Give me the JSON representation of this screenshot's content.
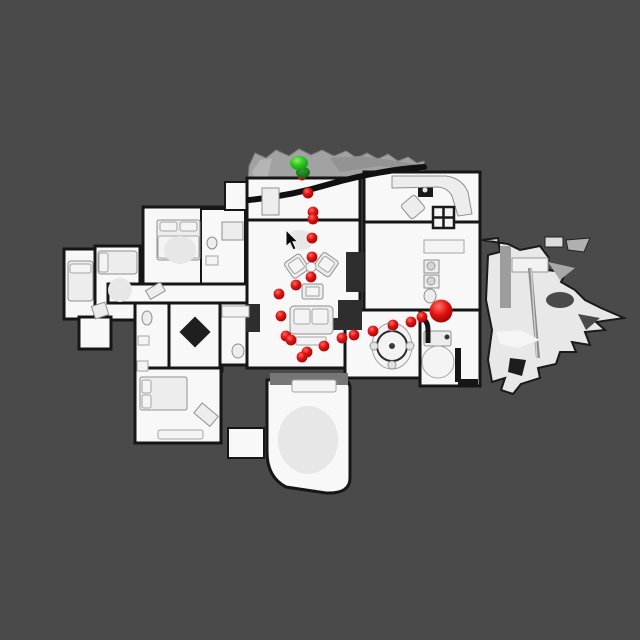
{
  "scene": {
    "description": "Top-down orthographic view of a 3D-scanned house interior with a navigation trajectory overlay",
    "background_color": "#4a4a4a",
    "floor_color": "#f8f8f8",
    "wall_color": "#161616",
    "balcony_color": "#a2a2a2"
  },
  "trajectory": {
    "start_marker": {
      "x": 299,
      "y": 163,
      "rx": 9,
      "ry": 7,
      "color": "#23c31f",
      "role": "start"
    },
    "start_marker_secondary": {
      "x": 303,
      "y": 172.5,
      "rx": 7,
      "ry": 5.5,
      "color": "#117c12",
      "role": "start-shadow"
    },
    "hidden_waypoint": {
      "x": 302,
      "y": 176,
      "r": 4.5
    },
    "goal_marker": {
      "x": 441,
      "y": 311,
      "r": 11.5,
      "color": "#d90f0f",
      "role": "goal"
    },
    "waypoint_color": "#d41111",
    "waypoint_radius": 5.4,
    "waypoints": [
      [
        308,
        193
      ],
      [
        313,
        212
      ],
      [
        313,
        219
      ],
      [
        312,
        238
      ],
      [
        312,
        257
      ],
      [
        311,
        277
      ],
      [
        296,
        285
      ],
      [
        279,
        294
      ],
      [
        281,
        316
      ],
      [
        286,
        336
      ],
      [
        291,
        340
      ],
      [
        307,
        352
      ],
      [
        302,
        357
      ],
      [
        324,
        346
      ],
      [
        342,
        338
      ],
      [
        354,
        335
      ],
      [
        373,
        331
      ],
      [
        393,
        325
      ],
      [
        411,
        322
      ],
      [
        422,
        317
      ]
    ]
  },
  "cursor": {
    "x": 286,
    "y": 230
  }
}
